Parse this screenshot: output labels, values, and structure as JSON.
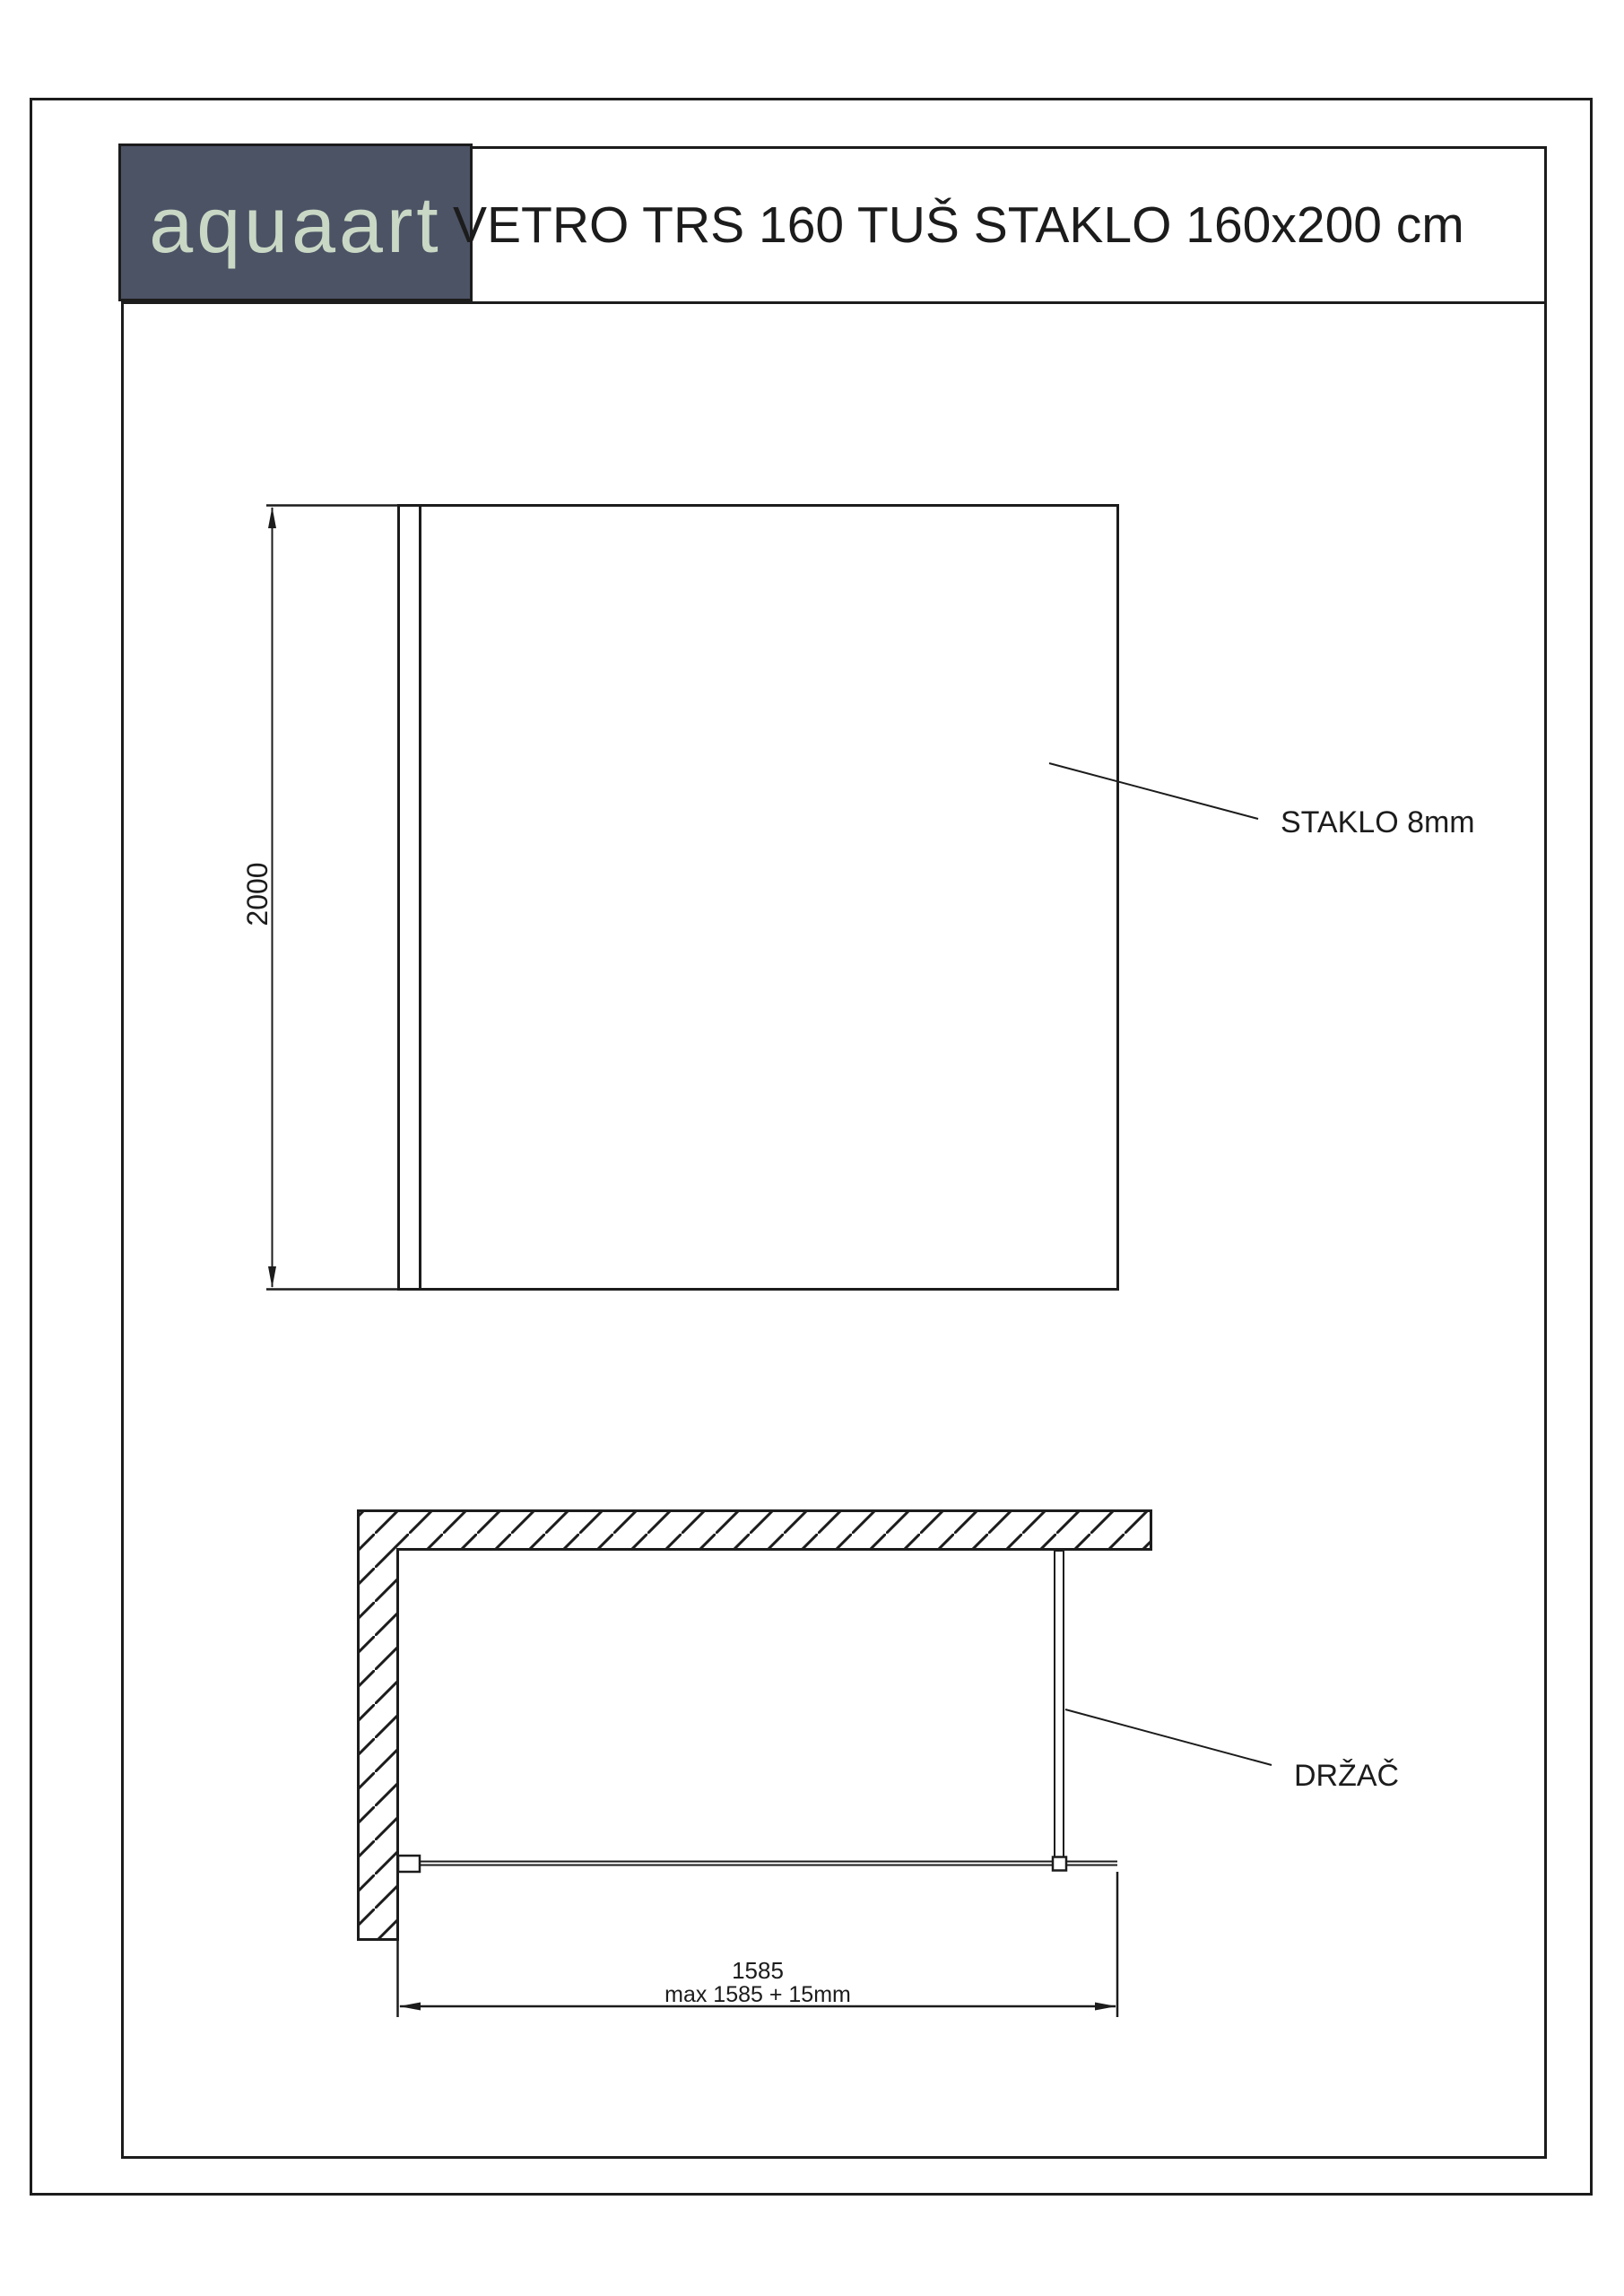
{
  "colors": {
    "line": "#1c1c1c",
    "brand_background": "#4c5365",
    "brand_text": "#c9d8c5",
    "paper": "#ffffff"
  },
  "header": {
    "brand": "aquaart",
    "title": "VETRO TRS 160 TUŠ STAKLO 160x200 cm"
  },
  "front_view": {
    "height_dimension": "2000",
    "glass_label": "STAKLO 8mm"
  },
  "plan_view": {
    "holder_label": "DRŽAČ",
    "width_dimension": "1585",
    "width_dimension_note": "max 1585 + 15mm"
  }
}
